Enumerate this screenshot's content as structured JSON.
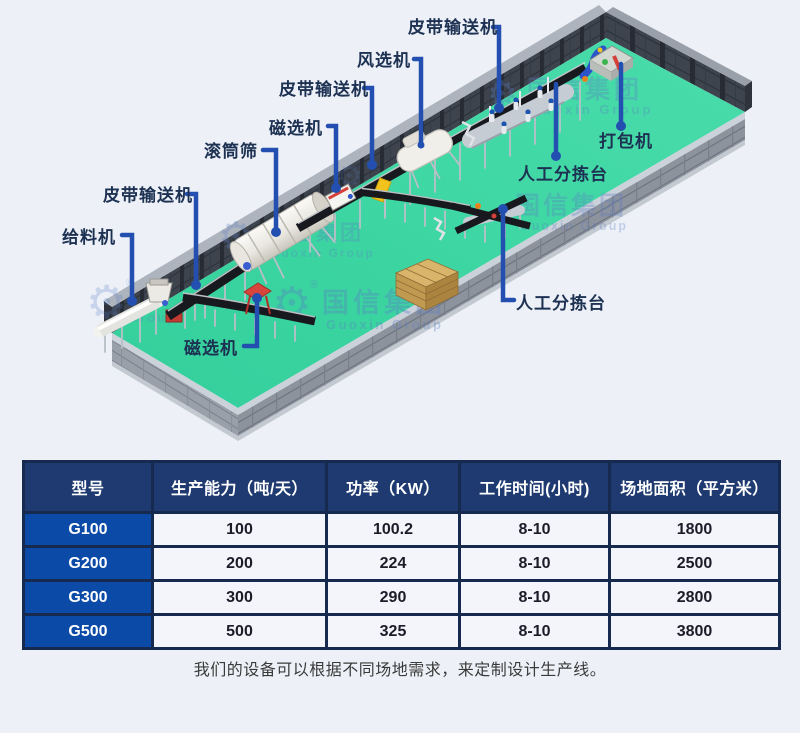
{
  "scene": {
    "labels": [
      {
        "id": "belt-conveyor-top",
        "text": "皮带输送机"
      },
      {
        "id": "air-separator",
        "text": "风选机"
      },
      {
        "id": "belt-conveyor-mid",
        "text": "皮带输送机"
      },
      {
        "id": "magnetic-separator-1",
        "text": "磁选机"
      },
      {
        "id": "trommel-screen",
        "text": "滚筒筛"
      },
      {
        "id": "belt-conveyor-left",
        "text": "皮带输送机"
      },
      {
        "id": "feeder",
        "text": "给料机"
      },
      {
        "id": "baler",
        "text": "打包机"
      },
      {
        "id": "manual-sorting-1",
        "text": "人工分拣台"
      },
      {
        "id": "manual-sorting-2",
        "text": "人工分拣台"
      },
      {
        "id": "magnetic-separator-2",
        "text": "磁选机"
      }
    ],
    "watermark": {
      "cn": "国信集团",
      "en": "Guoxin Group",
      "en_short": "Group",
      "reg": "®"
    }
  },
  "table": {
    "headers": [
      "型号",
      "生产能力（吨/天）",
      "功率（KW）",
      "工作时间(小时)",
      "场地面积（平方米）"
    ],
    "rows": [
      [
        "G100",
        "100",
        "100.2",
        "8-10",
        "1800"
      ],
      [
        "G200",
        "200",
        "224",
        "8-10",
        "2500"
      ],
      [
        "G300",
        "300",
        "290",
        "8-10",
        "2800"
      ],
      [
        "G500",
        "500",
        "325",
        "8-10",
        "3800"
      ]
    ]
  },
  "caption": {
    "text": "我们的设备可以根据不同场地需求，来定制设计生产线。"
  },
  "colors": {
    "background": "#edf1f7",
    "floor": "#3fd7a4",
    "wall": "#3e444e",
    "label_text": "#1d3152",
    "leader_line": "#2350b0",
    "table_header_bg": "#1e3a70",
    "model_col_bg": "#0b4aa6",
    "table_border": "#16294f",
    "cell_bg": "#f3f5fa"
  }
}
